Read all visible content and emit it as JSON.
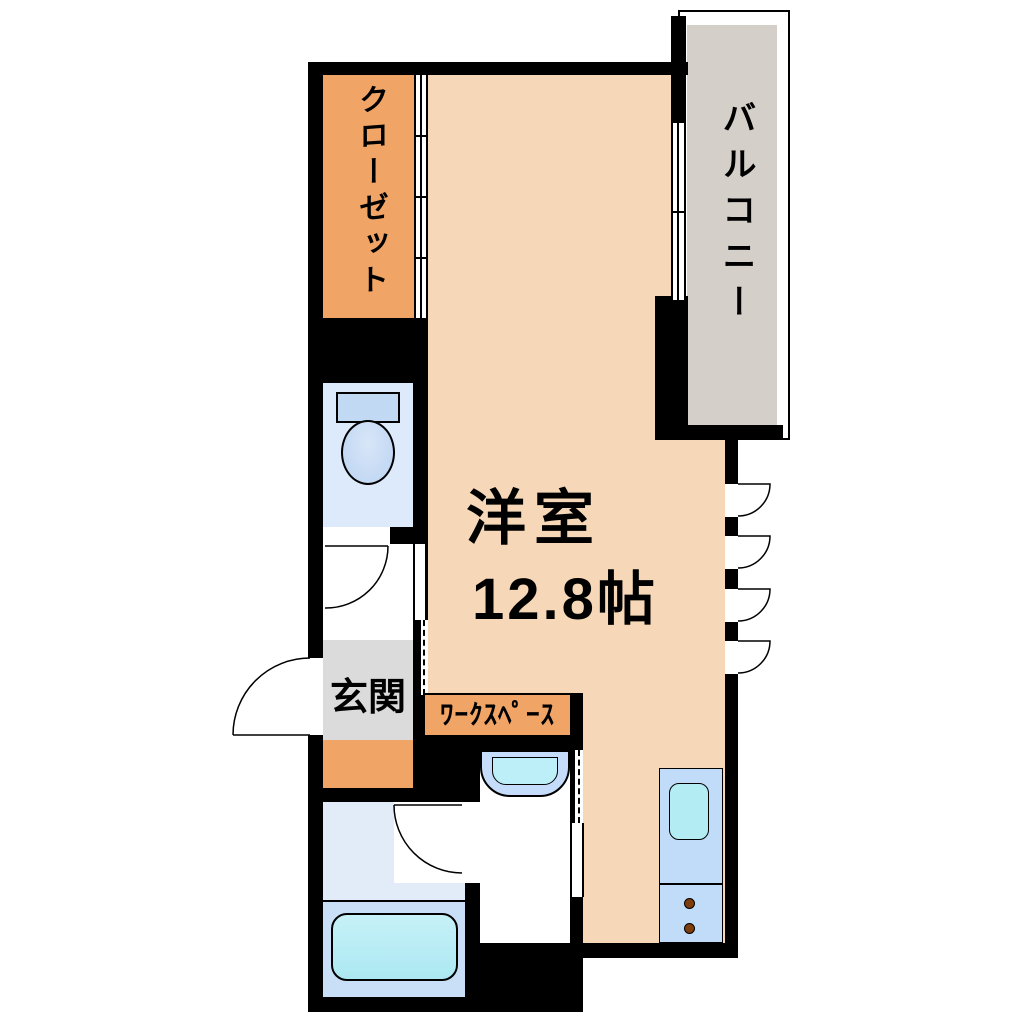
{
  "diagram_type": "apartment-floor-plan",
  "rooms": {
    "closet": {
      "label": "クローゼット"
    },
    "balcony": {
      "label": "バルコニー"
    },
    "main_room": {
      "label": "洋室",
      "size": "12.8帖"
    },
    "entrance": {
      "label": "玄関"
    },
    "workspace": {
      "label": "ﾜｰｸｽﾍﾟｰｽ"
    }
  },
  "fixtures": {
    "toilet": "toilet-icon",
    "bathtub": "bathtub-icon",
    "washbasin": "washbasin-icon",
    "kitchen_sink": "kitchen-sink-icon",
    "stove_burners": "stove-burners-icon",
    "swing_doors": "door-swing-arc",
    "casement_windows": "casement-window-arc",
    "sliding_doors": "sliding-door-panel"
  },
  "colors": {
    "wall": "#000000",
    "room_floor_peach": "#F6D8B8",
    "accent_orange": "#F0A466",
    "balcony_gray": "#D4CFC8",
    "entrance_gray": "#DBDBDB",
    "toilet_room_blue": "#DCE9FA",
    "bathroom_light_blue": "#E2ECF9",
    "bathroom_blue": "#C9DFF8",
    "fixture_blue": "#C2D9F4",
    "washbasin_blue": "#C5DDFA",
    "water_cyan": "#B4ECF4",
    "kitchen_blue": "#C0DCF8",
    "burner_brown": "#7E3D0A"
  }
}
